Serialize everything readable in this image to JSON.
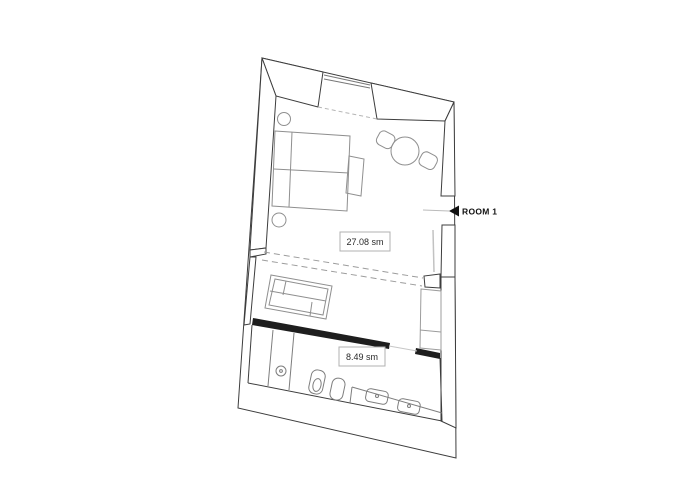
{
  "floorplan": {
    "rooms": [
      {
        "area_label": "27.08 sm"
      },
      {
        "area_label": "8.49 sm"
      }
    ],
    "marker": {
      "label": "ROOM 1",
      "icon": "left-arrow-icon"
    },
    "colors": {
      "background": "#ffffff",
      "wall_line": "#3d3d3d",
      "dark_wall": "#1e1e1e",
      "furniture_line": "#8f8f8f",
      "fixture_line": "#7d7d7d",
      "dashed_line": "#9c9c9c",
      "window_line": "#777777",
      "leader_line": "#bbbbbb",
      "label_border": "#b0b0b0",
      "label_text": "#2a2a2a",
      "marker_text": "#111111"
    }
  }
}
